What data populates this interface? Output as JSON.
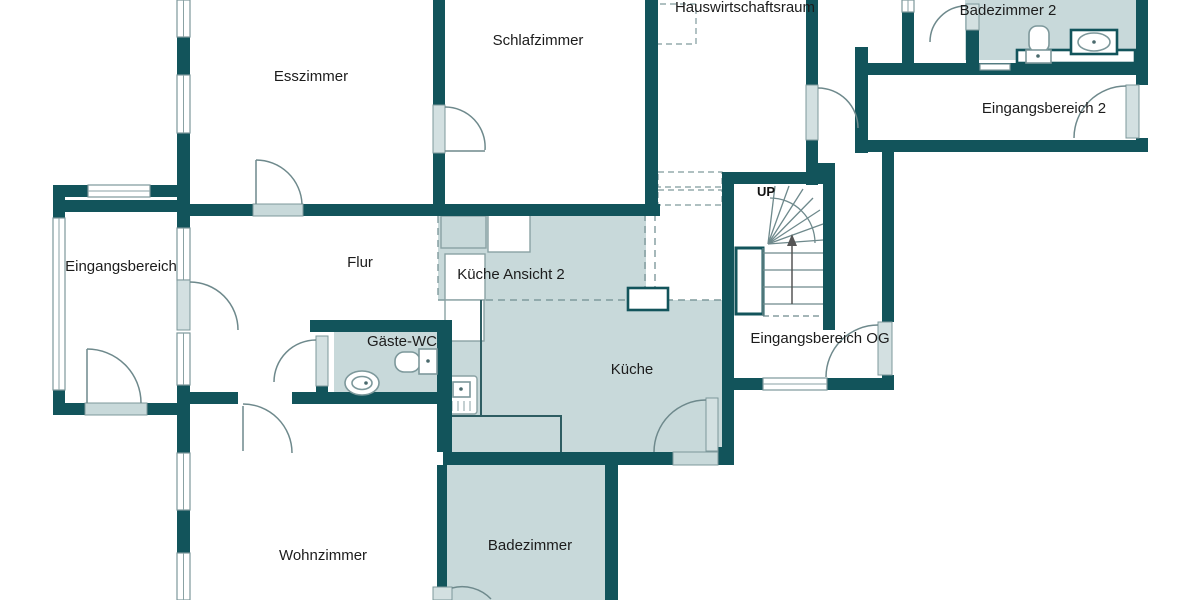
{
  "plan_title": "Floor plan (German residential, ground + upper entry fragment)",
  "rooms": [
    {
      "id": "esszimmer",
      "label": "Esszimmer"
    },
    {
      "id": "schlafzimmer",
      "label": "Schlafzimmer"
    },
    {
      "id": "hauswirtschaftsraum",
      "label": "Hauswirtschaftsraum"
    },
    {
      "id": "badezimmer-2",
      "label": "Badezimmer 2"
    },
    {
      "id": "eingangsbereich-2",
      "label": "Eingangsbereich 2"
    },
    {
      "id": "eingangsbereich",
      "label": "Eingangsbereich"
    },
    {
      "id": "flur",
      "label": "Flur"
    },
    {
      "id": "kueche-ansicht-2",
      "label": "Küche Ansicht 2"
    },
    {
      "id": "gaeste-wc",
      "label": "Gäste-WC"
    },
    {
      "id": "kueche",
      "label": "Küche"
    },
    {
      "id": "eingangsbereich-og",
      "label": "Eingangsbereich OG"
    },
    {
      "id": "wohnzimmer",
      "label": "Wohnzimmer"
    },
    {
      "id": "badezimmer",
      "label": "Badezimmer"
    }
  ],
  "stairs": {
    "up_label": "UP"
  },
  "fixtures": [
    "staircase-winder",
    "up-arrow",
    "guest-wc-sink",
    "guest-wc-toilet",
    "bathroom2-toilet",
    "bathroom2-sink",
    "bathroom2-vanity-counter",
    "kitchen-stove",
    "kitchen-counter",
    "kitchen-cabinets",
    "chimney-shaft"
  ],
  "colors": {
    "wall": "#12545b",
    "room_fill": "#c8d9da",
    "door_leaf": "#d3e0e1",
    "outline_gray": "#7d989b",
    "background": "#ffffff",
    "text": "#1c1c1c"
  }
}
